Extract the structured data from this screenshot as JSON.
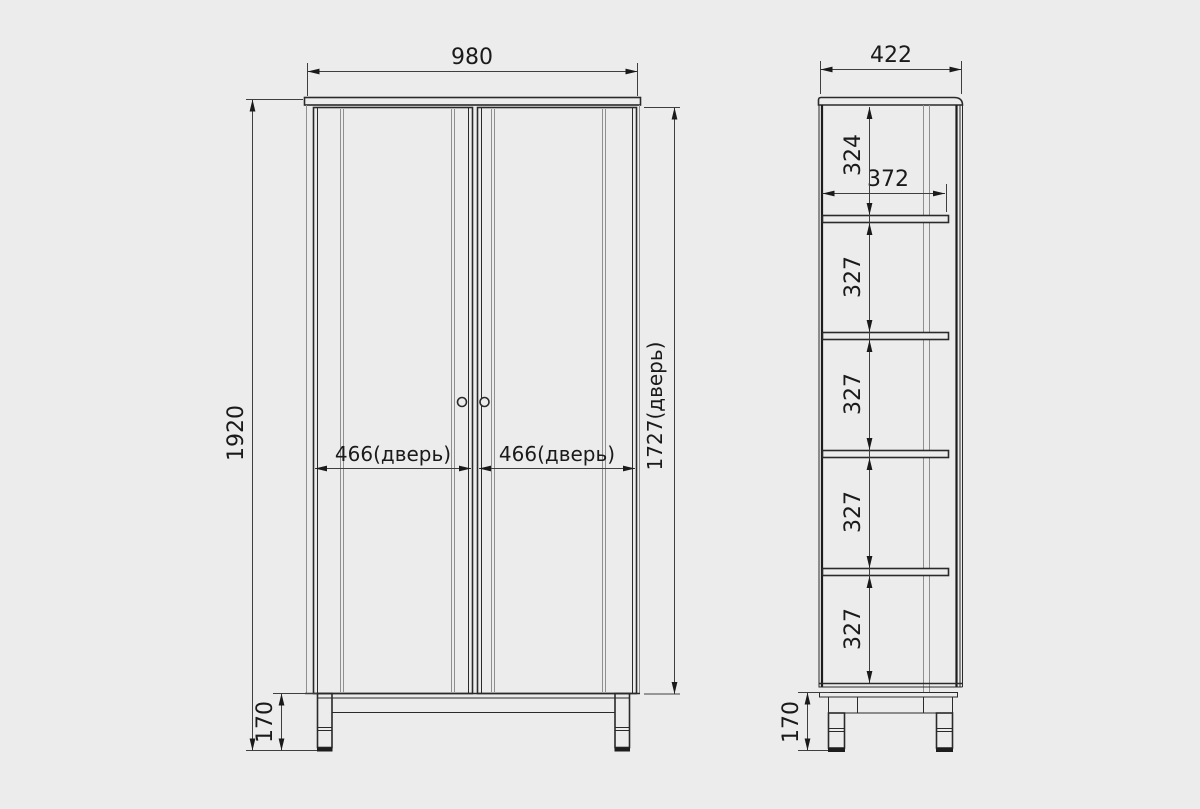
{
  "front_view": {
    "width": "980",
    "height": "1920",
    "left_door_width": "466(дверь)",
    "right_door_width": "466(дверь)",
    "door_height": "1727(дверь)",
    "leg_height": "170"
  },
  "side_view": {
    "depth": "422",
    "top_shelf_gap": "324",
    "inner_depth": "372",
    "shelf_gaps": [
      "327",
      "327",
      "327",
      "327"
    ],
    "leg_height": "170"
  },
  "colors": {
    "background": "#ececec",
    "line_dark": "#2a2a2a",
    "line_gray": "#8f8f8f",
    "dimension_line": "#3f3f3f",
    "text": "#1a1a1a"
  }
}
